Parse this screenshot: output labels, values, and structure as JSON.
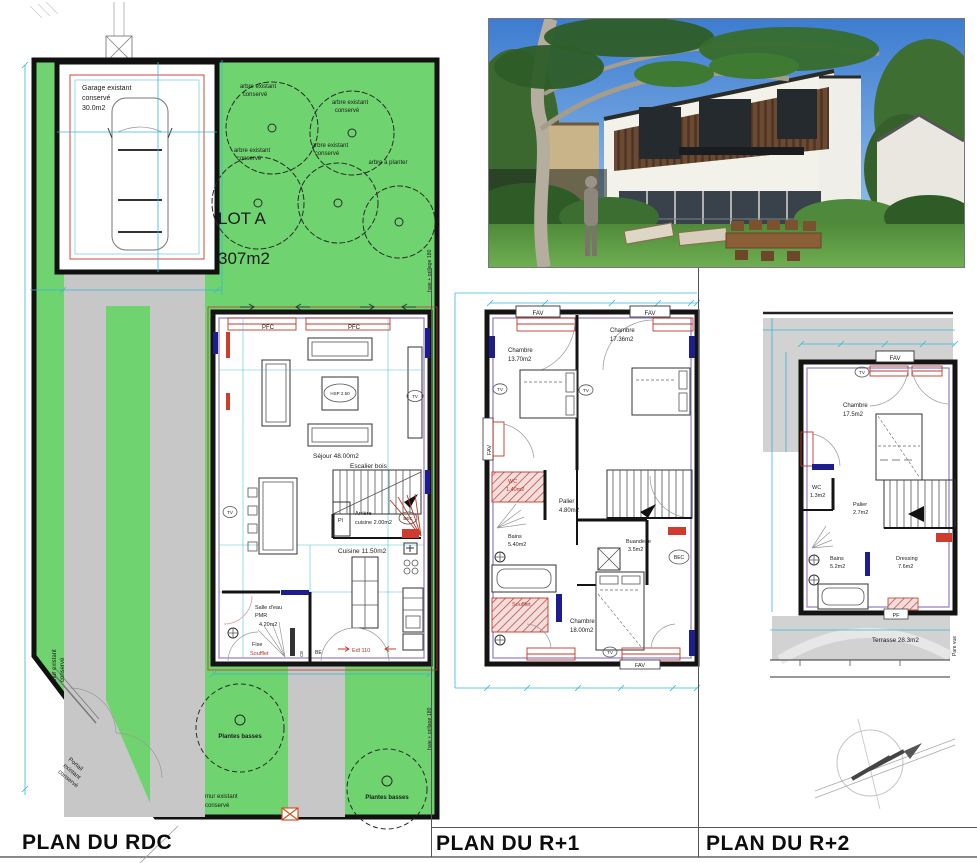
{
  "colors": {
    "lawn": "#6fd46f",
    "paving": "#c7c7c7",
    "terrace": "#d2d2d2",
    "dimension_cyan": "#35b6da",
    "wall_black": "#141414",
    "inner_wall_purple": "#9a86c6",
    "annotation_red": "#b03428",
    "window_navy": "#1d1d8f"
  },
  "panels": {
    "rdc_title": "PLAN DU RDC",
    "r1_title": "PLAN DU R+1",
    "r2_title": "PLAN DU R+2"
  },
  "site": {
    "lot": "LOT A",
    "area": "307m2",
    "garage": [
      "Garage existant",
      "conservé",
      "30.0m2"
    ],
    "tree_existing": [
      "arbre existant",
      "conservé"
    ],
    "tree_new": "arbre à planter",
    "hedge": "haie + grillage 180",
    "wall_left": [
      "mur existant",
      "conservé"
    ],
    "wall_bottom": [
      "mur existant",
      "conservé"
    ],
    "gate": [
      "Portail",
      "existant",
      "conservé"
    ],
    "plants": "Plantes basses"
  },
  "rdc": {
    "pfc": "PFC",
    "hsp": "HSP 2.50",
    "tv": "TV",
    "sejour": "Séjour 48.00m2",
    "escalier": "Escalier bois",
    "pl": "Pl",
    "arriere_cuisine": [
      "Arrière",
      "cuisine 2.00m2"
    ],
    "bec": "BEC",
    "cuisine": "Cuisine 11.50m2",
    "salle_eau": [
      "Salle d'eau",
      "PMR",
      "4.20m2"
    ],
    "fixe": "Fixe",
    "soufflet": "Soufflet",
    "ce": "CE",
    "be": "BE",
    "edl": "Edl 110"
  },
  "r1": {
    "fav": "FAV",
    "chambre1": [
      "Chambre",
      "13.70m2"
    ],
    "chambre2": [
      "Chambre",
      "17.36m2"
    ],
    "chambre3": [
      "Chambre",
      "18.00m2"
    ],
    "tv": "TV",
    "wc": [
      "WC",
      "1.40m2"
    ],
    "palier": [
      "Palier",
      "4.80m2"
    ],
    "bains": [
      "Bains",
      "5.40m2"
    ],
    "buanderie": [
      "Buanderie",
      "3.5m2"
    ],
    "bec": "BEC",
    "soufflet": "Soufflet"
  },
  "r2": {
    "fav": "FAV",
    "tv": "TV",
    "chambre": [
      "Chambre",
      "17.5m2"
    ],
    "wc": [
      "WC",
      "1.3m2"
    ],
    "palier": [
      "Palier",
      "2.7m2"
    ],
    "bains": [
      "Bains",
      "5.2m2"
    ],
    "dressing": [
      "Dressing",
      "7.6m2"
    ],
    "pf": "PF",
    "terrasse": "Terrasse 28.3m2",
    "pare_vue": "Pare vue"
  }
}
